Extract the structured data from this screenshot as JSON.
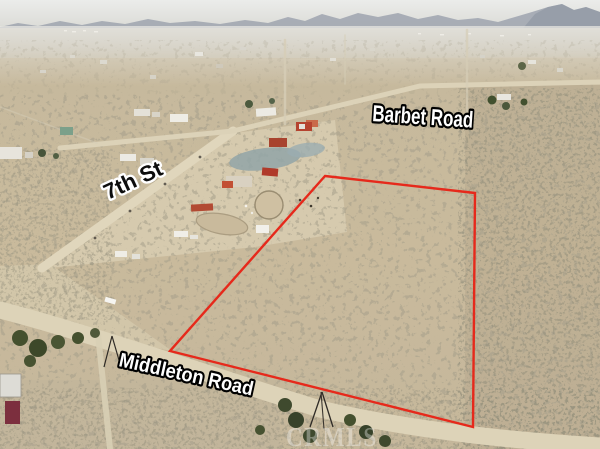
{
  "title": "Aerial parcel listing photo",
  "labels": {
    "top_road": "Barbet Road",
    "left_street": "7th St",
    "bottom_road": "Middleton Road"
  },
  "watermark": "CRMLS",
  "colors": {
    "boundary": "#e6291b",
    "label_light": "#ffffff",
    "label_dark": "#0d0d0d",
    "outline_dark": "#000000",
    "outline_light": "#ffffff",
    "watermark_fill": "#ffffff",
    "desert_base": "#c7b898",
    "road_dirt": "#ded3b8",
    "mountain": "#a4aab3"
  },
  "scene": {
    "parcel_points": "325,176 475,193 473,427 170,351",
    "roads": {
      "barbet": "M60,148 L233,131 L420,86 L600,82",
      "seventh": "M42,268 L233,131",
      "middleton": "M0,310 C90,333 230,382 320,409 C420,432 520,441 600,446",
      "branch_track": "M98,334 L110,449",
      "north_a": "M285,40 L285,124",
      "north_b": "M467,30 L467,112",
      "north_c": "M345,35 L345,84",
      "far_cross": "M260,60 L600,57",
      "west_line": "M0,107 L97,143"
    }
  }
}
